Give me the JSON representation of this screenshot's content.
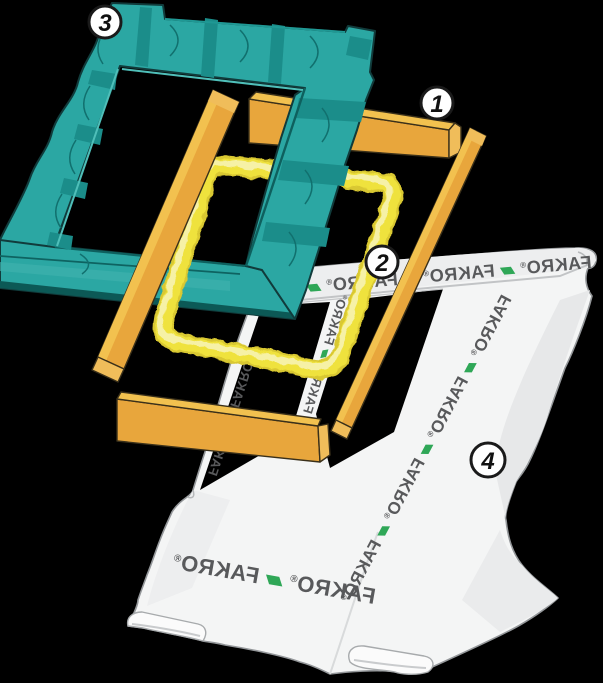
{
  "title": "Roof window installation kit exploded diagram",
  "background_color": "#000000",
  "colors": {
    "teal_main": "#2BA7A3",
    "teal_band": "#1B8D8A",
    "teal_line": "#11706E",
    "teal_dark_lip": "#0C5956",
    "teal_outline": "#113B3B",
    "teal_rim_light": "#4FBFB9",
    "batten_face": "#E8A63C",
    "batten_top": "#F2C14F",
    "batten_end": "#F0BD5A",
    "batten_outline": "#3A301A",
    "foam_main": "#EFE23E",
    "foam_shadow": "#D9C830",
    "foam_highlight": "#F6F1A6",
    "membrane_fill": "#F4F5F5",
    "membrane_shade": "#E6E7E8",
    "membrane_outline": "#94979A",
    "brand_text": "#58595B",
    "brand_green": "#2FA757",
    "badge_fill": "#FFFFFF",
    "badge_ring": "#1A1A1A"
  },
  "badges": [
    {
      "number": "1",
      "x": 437,
      "y": 103,
      "r": 16
    },
    {
      "number": "2",
      "x": 382,
      "y": 262,
      "r": 16
    },
    {
      "number": "3",
      "x": 105,
      "y": 22,
      "r": 16
    },
    {
      "number": "4",
      "x": 488,
      "y": 460,
      "r": 17
    }
  ],
  "membrane": {
    "brand_word": "FAKRO",
    "reg_mark": "®",
    "separator_glyph": "▰",
    "bands": [
      {
        "name": "top-band",
        "x": 592,
        "y": 268,
        "rotate": -5,
        "size": 18,
        "words": [
          "FAKRO",
          "FAKRO",
          "FAKRO",
          "FAKRO"
        ]
      },
      {
        "name": "right-band",
        "x": 512,
        "y": 299,
        "rotate": -62,
        "size": 17,
        "words": [
          "FAKRO",
          "FAKRO",
          "FAKRO",
          "FAKRO"
        ]
      },
      {
        "name": "bottom-band",
        "x": 374,
        "y": 604,
        "rotate": 10,
        "size": 22,
        "words": [
          "FAKRO",
          "FAKRO"
        ]
      },
      {
        "name": "left-strip-band",
        "x": 208,
        "y": 474,
        "rotate": 108,
        "size": 13,
        "words": [
          "FAKRO",
          "FAKRO"
        ]
      },
      {
        "name": "inner-strip-band",
        "x": 303,
        "y": 412,
        "rotate": 107,
        "size": 13,
        "words": [
          "FAKRO",
          "FAKRO"
        ]
      }
    ]
  },
  "legend_meaning": {
    "1": "wooden battens",
    "2": "foam seal frame",
    "3": "flashing insulation frame",
    "4": "underlay membrane collar"
  }
}
